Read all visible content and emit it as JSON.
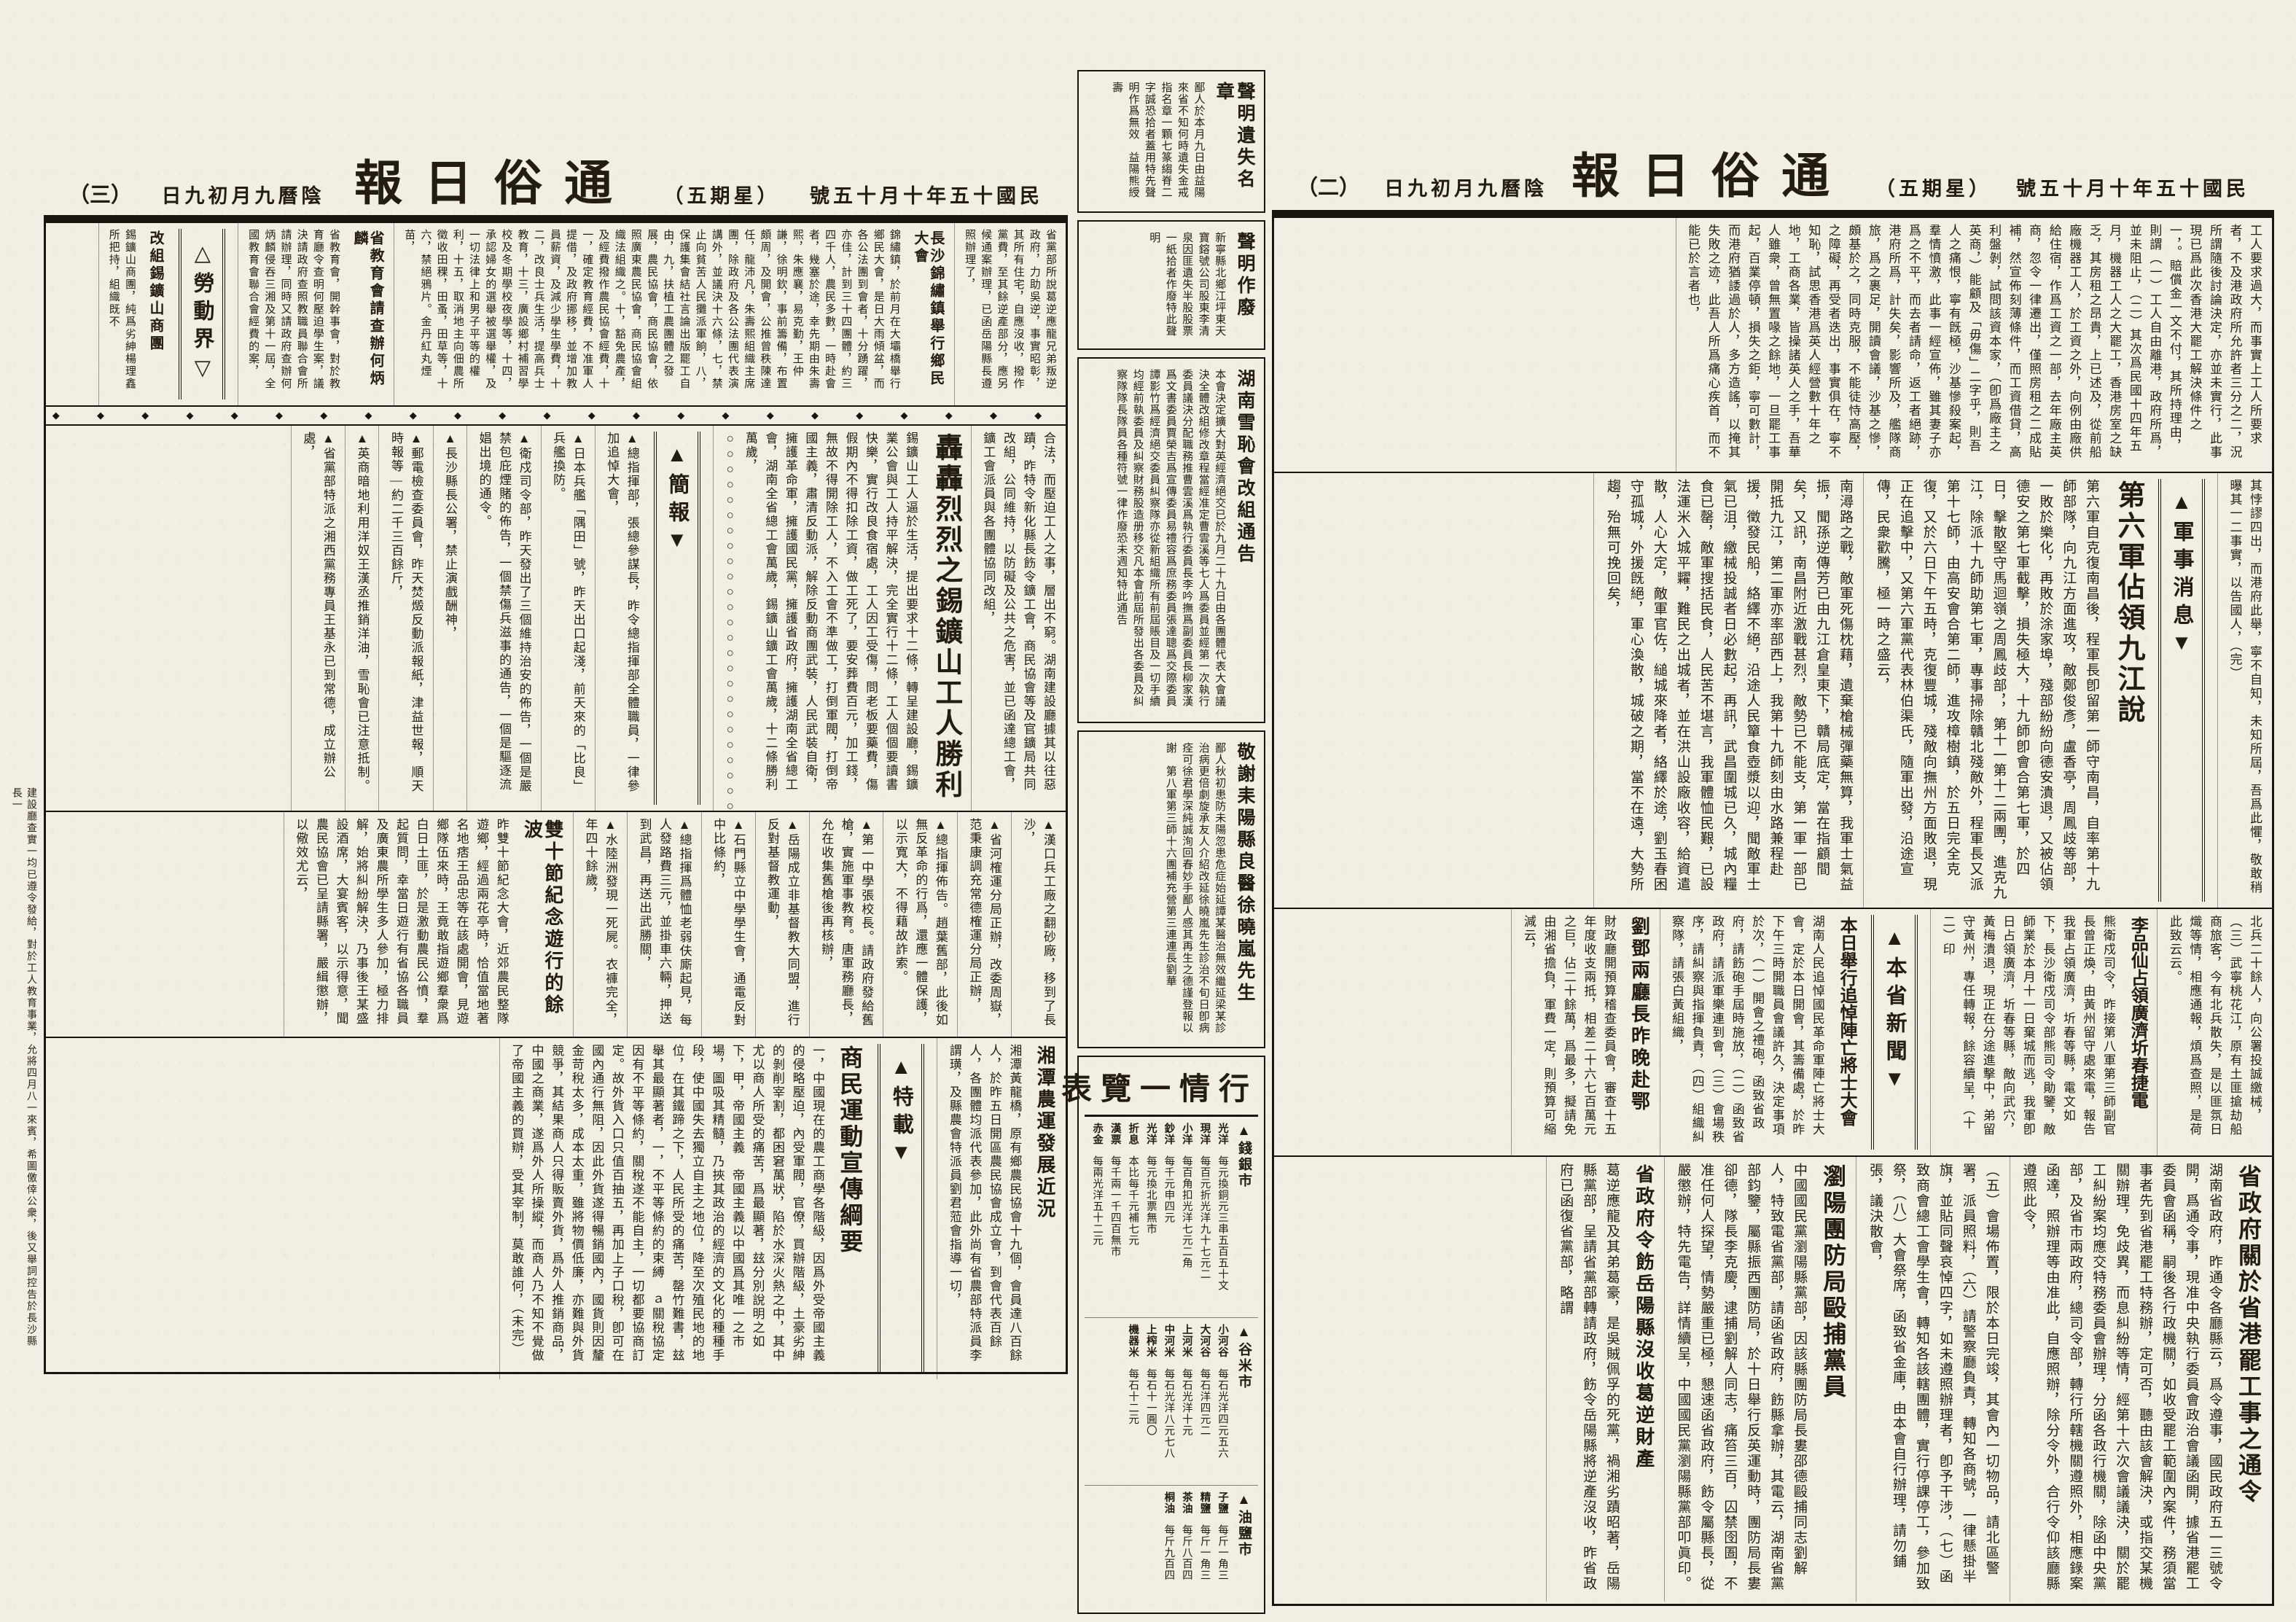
{
  "masthead": {
    "title": "通俗日報",
    "date": "民國十五年十月十五號",
    "weekday": "（星期五）",
    "lunar_date": "陰曆九月初九日",
    "page_no_right": "（二）",
    "page_no_left": "（三）"
  },
  "right": {
    "lead": {
      "p1": "工人要求過大，而事實上工人所要求者，不及港政府所允許者三分之二，況所謂隨後討論決定，亦並未實行，此事現已爲此次香港大罷工解決條件之一，。賠償金一文不付，其所持理由，則謂（一）工人自由離港，政府所爲，並未阻止，（二）其次爲民國十四年五月，機器工人之大罷工，香港房室之缺乏，其房租之昂貴，上已述及，從前船廠機器工人，於工資之外，向例由廠供給住宿，作爲工資之一部，去年廠主英商，忽令一律遷出，僅照房租之二成貼補，然宣佈刻薄條件，而工資借貸，高利盤剝，試問該資本家，（卽爲廠主之英商，）能顧及「毋傷」二字乎，則吾人之痛恨，寧有旣極，沙基慘殺案起，羣情憤激，此事一經宣佈，雖其妻子亦爲之不平，而去者請命，返工者絕跡，港府所爲，計失矣，影響所及，艦隊商旅，爲之裹足，開讀會議，沙基之慘，頗基於之，同時克服，不能徒恃高壓，之障礙，再受者迭出，事實俱在，寧不知恥，試思香港爲英人經營數十年之地，工商各業，皆操諸英人之手，吾華人雖衆，曾無置喙之餘地，一旦罷工事起，百業停頓，損失之鉅，寧可數計，而港府猶諉過於人，多方造謠，以掩其失敗之迹，此吾人所爲痛心疾首，而不能已於言者也，",
      "p2": "其悖謬四出，而港府此舉，寧不自知，未知所屆，吾爲此懼，敬敢稍曝其一二事實，以告國人，（完）"
    },
    "military_kicker": "▲軍事消息▼",
    "jiujiang": {
      "headline": "第六軍佔領九江說",
      "body": "第六軍自克復南昌後，程軍長卽留第一師守南昌，自率第十九師部隊，向九江方面進攻，敵鄭俊彥，盧香亭，周鳳歧等部，一敗於樂化，再敗於涂家埠，殘部紛紛向德安潰退，又被佔領德安之第七軍截擊，損失極大，十九師卽會合第七軍，於四日，擊散堅守馬迴嶺之周鳳歧部，，第十一第十二兩團，進克九江，除派十九師助第七軍，專事掃除贛北殘敵外，程軍長又派第十七師，由高安會合第二師，進攻樟樹鎮，於五日完全克復，又於六日下午五時，克復豐城，殘敵向撫州方面敗退，現正在追擊中，又第六軍黨代表林伯渠氏，隨軍出發，沿途宣傳，民衆歡騰，極一時之盛云，"
    },
    "military_cont": "南潯路之戰，敵軍死傷枕藉，遺棄槍械彈藥無算，我軍士氣益振，聞孫逆傳芳已由九江倉皇東下，贛局底定，當在指顧間矣，又訊，南昌附近激戰甚烈，敵勢已不能支，第一軍一部已開抵九江，第二軍亦率部西上，我第十九師刻由水路兼程赴援，徵發民船，絡繹不絕，沿途人民簞食壺漿以迎，聞敵軍士氣已沮，繳械投誠者日必數起，再訊，武昌圍城已久，城內糧食已罄，敵軍搜括民食，人民苦不堪言，我軍體恤民艱，已設法運米入城平糶，難民之出城者，並在洪山設廠收容，給資遣散，人心大定，敵軍官佐，縋城來降者，絡繹於途，劉玉春困守孤城，外援旣絕，軍心渙散，城破之期，當不在遠，大勢所趨，殆無可挽回矣，",
    "surrender_brief": "北兵二十餘人，向公署投誠繳械，（三）武寧桃花江，原有土匪搶劫船商旅客，今有北兵散失，是以匪氛日熾等情，相應通報，煩爲查照，是荷此致云云。",
    "lipinxian": {
      "headline": "李品仙占領廣濟圻春捷電",
      "body": "熊衛戍司令，昨接第八軍第三師副官長曾正煥，由黃州留守處來電，報告我軍占領廣濟，圻春等縣，電文如下，長沙衛戍司令部熊司令勛鑒，敵師業於本月十一日棄城而逃，我軍卽日占領廣濟，圻春等縣，敵向武穴，黃梅潰退，現正在分途進擊中，弟留守黃州，專任轉報，餘容續呈，（十二）印"
    },
    "province_kicker": "▲本省新聞▼",
    "memorial": {
      "headline": "本日舉行追悼陣亡將士大會",
      "body1": "湖南人民追悼國民革命軍陣亡將士大會，定於本日開會，其籌備處，於昨下午三時開職員會議許久，決定事項於次，（一）開會之禮砲，函致省政府，請飭砲手屆時施放，（二）函致省政府，請派軍樂連到會，（三）會場秩序，請糾察與指揮負責，（四）組織糾察隊，請張白黃組織，",
      "body2": "（五）會場佈置，限於本日完竣，其會內一切物品，請北區警署，派員照料，（六）請警察廳負責，轉知各商號，一律懸掛半旗，並貼同聲哀悼四字，如未遵照辦理者，卽予干涉，（七）函致商會總工會學生會，轉知各該轄團體，實行停課停工，參加致祭，（八）大會祭席，函致省金庫，由本會自行辦理，請勿鋪張，議決散會，"
    },
    "liudeng": {
      "headline": "劉鄧兩廳長昨晚赴鄂",
      "body": "財政廳開預算稽查委員會，審查十五年度收支兩抵，相差二十六七百萬元之巨，佔二十餘萬，爲最多，擬請免由湘省擔負，軍費一定，則預算可縮減云，"
    },
    "strike_order": {
      "headline": "省政府關於省港罷工事之通令",
      "body": "湖南省政府，昨通令各廳縣云，爲令遵事，國民政府五一三號令開，爲通令事，現准中央執行委員會政治會議函開，據省港罷工委員會函稱，嗣後各行政機關，如收受罷工範圍內案件，務須當事者先到省港罷工特務辦，定可否，聽由該會解決，或指交某機關辦理，免歧異，而息糾紛等情，經第十六次會議議決，關於罷工糾紛案均應交特務委員會辦理，分函各政行機關，除函中央黨部，及省市兩政府，總司令部，轉行所轄機關遵照外，相應錄案函達，照辦理等由准此，自應照辦，除分令外，合行令仰該廳縣遵照此令，"
    },
    "liuyang": {
      "headline": "瀏陽團防局毆捕黨員",
      "body": "中國國民黨瀏陽縣黨部，因該縣團防局長婁邵德毆捕同志劉解人，特致電省黨部，請函省政府，飭縣拿辦，其電云，湖南省黨部鈞鑒，屬縣振西團防局，於十日舉行反英運動時，團防局長婁卻德，隊長李克慶，逮捕劉解人同志，痛笞三百，囚禁囹圄，不准任何人探望，情勢嚴重已極，懇速函省政府，飭令屬縣長，從嚴懲辦，特先電告，詳情續呈，中國國民黨瀏陽縣黨部叩眞印。"
    },
    "yueyang": {
      "headline": "省政府令飭岳陽縣沒收葛逆財產",
      "body": "葛逆應龍及其弟葛豪，是吳賊佩孚的死黨，禍湘劣蹟昭著，岳陽縣黨部，呈請省黨部轉請政府，飭令岳陽縣將逆產沒收，昨省政府已函復省黨部，略謂"
    }
  },
  "gutter": {
    "ad_lost_seal": {
      "headline": "聲明遺失名章",
      "body": "鄙人於本月九日由益陽來省不知何時遺失金戒指名章一顆七篆縐脊二字誠恐拾者蓋用特先聲明作爲無效　益陽熊綬壽"
    },
    "ad_void": {
      "headline": "聲明作廢",
      "body": "新寧縣北鄉江坪東天寶鎔號公司股東李清泉因匪遺失半股股票一紙拾者作廢特此聲明"
    },
    "xuechi": {
      "headline": "湖南雪恥會改組通告",
      "body": "本會決定擴大對英經濟絕交已於九月二十九日由各團體代表大會議決全體改組修改章程當經准定曹雲溪等七人爲委員並經第一次執行委員議決分配職務推曹雲溪爲執行委員長李吟撫爲副委員長柳家漢爲文書委員賈榮吉爲宣傳委員易禮容爲庶務委員張達聰爲交際委員譚影竹爲經濟絕交委員糾察隊亦從新組織所有前屆賬目及一切手續均經前執委員及糾察財務股造册移交凡本會前屆所發出各委員及糾察隊隊長隊員各種符號一律作廢恐未週知特此通告"
    },
    "thanks": {
      "headline": "敬謝耒陽縣良醫徐曉嵐先生",
      "body": "鄙人秋初患防未陽忽患危症始延譚某醫治無效繼延梁某診治病更倍劇旋承友人介紹改延徐曉嵐先生診治不旬日卽病痊可徐君學深純誠洵回春妙手鄙人感其再生之德謹登報以謝　第八軍第三師十六團補充營第三連連長劉華"
    },
    "price_table": {
      "title": "行情一覽表",
      "money": {
        "kicker": "▲錢銀市",
        "rows": [
          {
            "item": "光洋",
            "price": "每元換銅元三串五百五十文"
          },
          {
            "item": "現洋",
            "price": "每百元折光洋九十七元二"
          },
          {
            "item": "小洋",
            "price": "每百角扣光洋七元二角"
          },
          {
            "item": "鈔洋",
            "price": "每千元申四元"
          },
          {
            "item": "光洋",
            "price": "每元換北票無市"
          },
          {
            "item": "折息",
            "price": "本比每千元補七元"
          },
          {
            "item": "漢票",
            "price": "每千兩一千四百無市"
          },
          {
            "item": "赤金",
            "price": "每兩光洋五十二元"
          }
        ]
      },
      "grain": {
        "kicker": "▲谷米市",
        "rows": [
          {
            "item": "小河谷",
            "price": "每石光洋四元五六"
          },
          {
            "item": "大河谷",
            "price": "每石洋四元二"
          },
          {
            "item": "上河米",
            "price": "每石光洋十元"
          },
          {
            "item": "中河米",
            "price": "每石光洋八元七八"
          },
          {
            "item": "上榨米",
            "price": "每石十一圓〇"
          },
          {
            "item": "機器米",
            "price": "每石十二元"
          }
        ]
      },
      "oil": {
        "kicker": "▲油鹽市",
        "rows": [
          {
            "item": "子鹽",
            "price": "每斤一角三"
          },
          {
            "item": "精鹽",
            "price": "每斤一角三"
          },
          {
            "item": "茶油",
            "price": "每斤八百四"
          },
          {
            "item": "桐油",
            "price": "每斤九百四"
          }
        ]
      }
    }
  },
  "left": {
    "geni_cont": "省黨部所說葛逆應龍兄弟叛逆政府，力助吳逆，事實昭彰，其所有住宅，自應沒收，撥作黨費，至其餘逆產部分，應另候通案辦理，已函岳陽縣長遵照辦理了，",
    "xiangmin": {
      "headline": "長沙錦繡鎮舉行鄉民大會",
      "body": "錦繡鎮，於前月在大壩橋舉行鄉民大會，是日大雨傾盆，而各公法團到會者，十分踴躍，亦佳，計到三十四團體，約三四千人，農民多數，一時赴會者，幾塞於途，幸先期由朱壽熙，朱應襄，易克勤，王仲謙，徐明欽，事前籌備，布置頗周，及開會，公推曾秩陳達任，龍沛凡，朱壽熙組織主席團，除政府及各公法團代表演講外，並議決十六條，七，禁止向貧苦人民攤派軍餉，八，保護集會結社言論出版罷工自由，九，扶植工農團體之發展，農民協會，商民協會，依照廣東農民協會，商民協會組織法組織之。十，豁免農產，及經費撥作農民協會經費，十一，確定教育經費，不准軍人提借，及政府挪移，並增加教員薪資，及減少學生學費，十二，改良士兵生活，提高兵士教育，十三，廣設鄉村補習學校及冬期學校夜學等，十四，承認婦女的選舉被選舉權，及一切法律上和男子平等的權利，十五，取消地主向佃農所徵收田稞，田蚤，田草等，十六，禁絕鴉片。金丹紅丸煙苗，"
    },
    "education": {
      "headline": "省教育會請查辦何炳麟",
      "body": "省教育會，開幹事會，對於教育廳令查明何壓迫學生案，議決請政府查照教職員聯合會所請辦理，同時又請政府查辦何炳麟侵吞三湘及第十一屆，全國教育會聯合會經費的案，"
    },
    "labor_kicker": "△勞動界▽",
    "shangtuan": {
      "headline": "改組錫鑛山商團",
      "body1": "錫鑛山商團，純爲劣紳楊理鑫所把持，組織既不",
      "body2": "合法，而壓迫工人之事，層出不窮。湖南建設廳據其以往惡蹟，昨特令新化縣長飭令鑛工會，商民協會等及官鑛局共同改組，公同維持，以防礙及公共之危害，並已函達總工會，鑛工會派員與各團體協同改組，"
    },
    "victory": {
      "headline": "轟轟烈烈之錫鑛山工人勝利",
      "body": "錫鑛山工人逼於生活，提出要求十二條，轉呈建設廳，錫鑛業公會與工人持平解決，完全實行十二條，工人個個要讀書快樂，實行改良食宿處，工人因工受傷，問老板要藥費，傷假期內不得扣除工資，做工死了，要安葬費百元，加工錢，無故不得開除工人，不入工會不準做工，打倒軍閥，打倒帝國主義，肅清反動派，解除反動商團武裝，人民武裝自衛，擁護革命軍，擁護國民黨，擁護省政府，擁護湖南全省總工會，湖南全省總工會萬歲，錫鑛山鑛工會萬歲，十二條勝利萬歲，○○○○○○○○○○○○○○○○○○○○○○○○○○○○○○"
    },
    "jianbao_kicker": "▲簡報▼",
    "briefs1": [
      "▲總指揮部，張總參謀長，昨令總指揮部全體職員，一律參加追悼大會，",
      "▲日本兵艦「隅田」號，昨天出口起淺，前天來的「比良」兵艦換防。",
      "▲衛戍司令部，昨天發出了三個維持治安的佈告，一個是嚴禁包庇煙賭的佈告，一個禁傷兵滋事的通告，一個是驅逐流娼出境的通令。",
      "▲長沙縣長公署，禁止演戲酬神，",
      "▲郵電檢查委員會，昨天焚燬反動派報紙，津益世報，順天時報等—約二千三百餘斤，",
      "▲英商暗地利用洋奴王漢丞推銷洋油，雪恥會已注意抵制。",
      "▲省黨部特派之湘西黨務專員王基永已到常德，成立辦公處，"
    ],
    "briefs2": [
      "▲漢口兵工廠之翻砂廠，移到了長沙，",
      "▲省河榷運分局正辦，改委周嶽，范秉康調充常德榷運分局正辦，",
      "▲總指揮佈告。趙葉舊部，此後如無反革命的行爲，還應一體保護，以示寬大，不得藉故詐索。",
      "▲第一中學張校長。請政府發給舊槍，實施軍事教育。唐軍務廳長，允在收集舊槍後再核辦，",
      "▲岳陽成立非基督教大同盟，進行反對基督教運動，",
      "▲石門縣立中學學生會，通電反對中比條約，",
      "▲總指揮爲體恤老弱伕廝起見，每人發路費三元，並掛車六輛，押送到武昌，再送出武勝關，",
      "▲水陸洲發現一死屍。衣褲完全，年四十餘歲，"
    ],
    "shuangshi": {
      "headline": "雙十節紀念遊行的餘波",
      "body": "昨雙十節紀念大會，近郊農民整隊遊鄉，經過兩花亭時，恰值當地著名地痞王品忠等在該處開會，見遊鄉隊伍來時，王竟敢指遊鄉羣衆爲白日土匪，於是激動農民公憤，羣起質問，幸當日遊行有省協各職員及廣東農所學生多人參加，極力排解，始將糾紛解決，乃事後王某盛設酒席，大宴賓客，以示得意，聞農民協會已呈請縣署，嚴緝懲辦，以儆效尤云，"
    },
    "nongyun": {
      "headline": "湘潭農運發展近況",
      "body": "湘潭黃龍橋，原有鄉農民協會十九個，會員達八百餘人，於昨五日開區農民協會成立會，到會代表百餘人，各團體均派代表參加，此外尚有省農部特派員李謂璜，及縣農會特派員劉君蒞會指導一切，"
    },
    "special_kicker": "▲特載▼",
    "gangyao": {
      "headline": "商民運動宣傳綱要",
      "body": "一，中國現在的農工商學各階級，因爲外受帝國主義的侵略壓迫，內受軍閥，官僚，買辦階級，土豪劣紳的剝削宰割，都困窘萬狀，陷於水深火熱之中，其中尤以商人所受的痛苦，爲最顯著，玆分別說明之如下，甲，帝國主義　帝國主義以中國爲其唯一之市場，圖吸其精髓，乃挾其政治的經濟的文化的種種手段，使中國失去獨立自主之地位，降至次殖民地的地位，在其鐵蹄之下，人民所受的痛苦，罄竹難書，玆舉其最顯著者，一，不平等條約的束縛　ａ關稅協定　因有不平等條約，關稅遂不能自主，一切都要協商訂定。故外貨入口只值百抽五，再加上子口稅，卽可在國內通行無阻，因此外貨遂得暢銷國內，國貨則因釐金苛稅太多，成本太重，雖將物價低廉，亦難與外貨競爭，其結果商人只得販賣外貨，爲外人推銷商品，中國之商業，遂爲外人所操縱，而商人乃不知不覺做了帝國主義的買辦，受其宰制，莫敢誰何，（未完）"
    },
    "edge_note": "建設廳查實一均已遵令發給，對於工人教育事業，允將四月八一來賓，希圖儌倖公衆，後又舉詞控告於長沙縣長一"
  }
}
